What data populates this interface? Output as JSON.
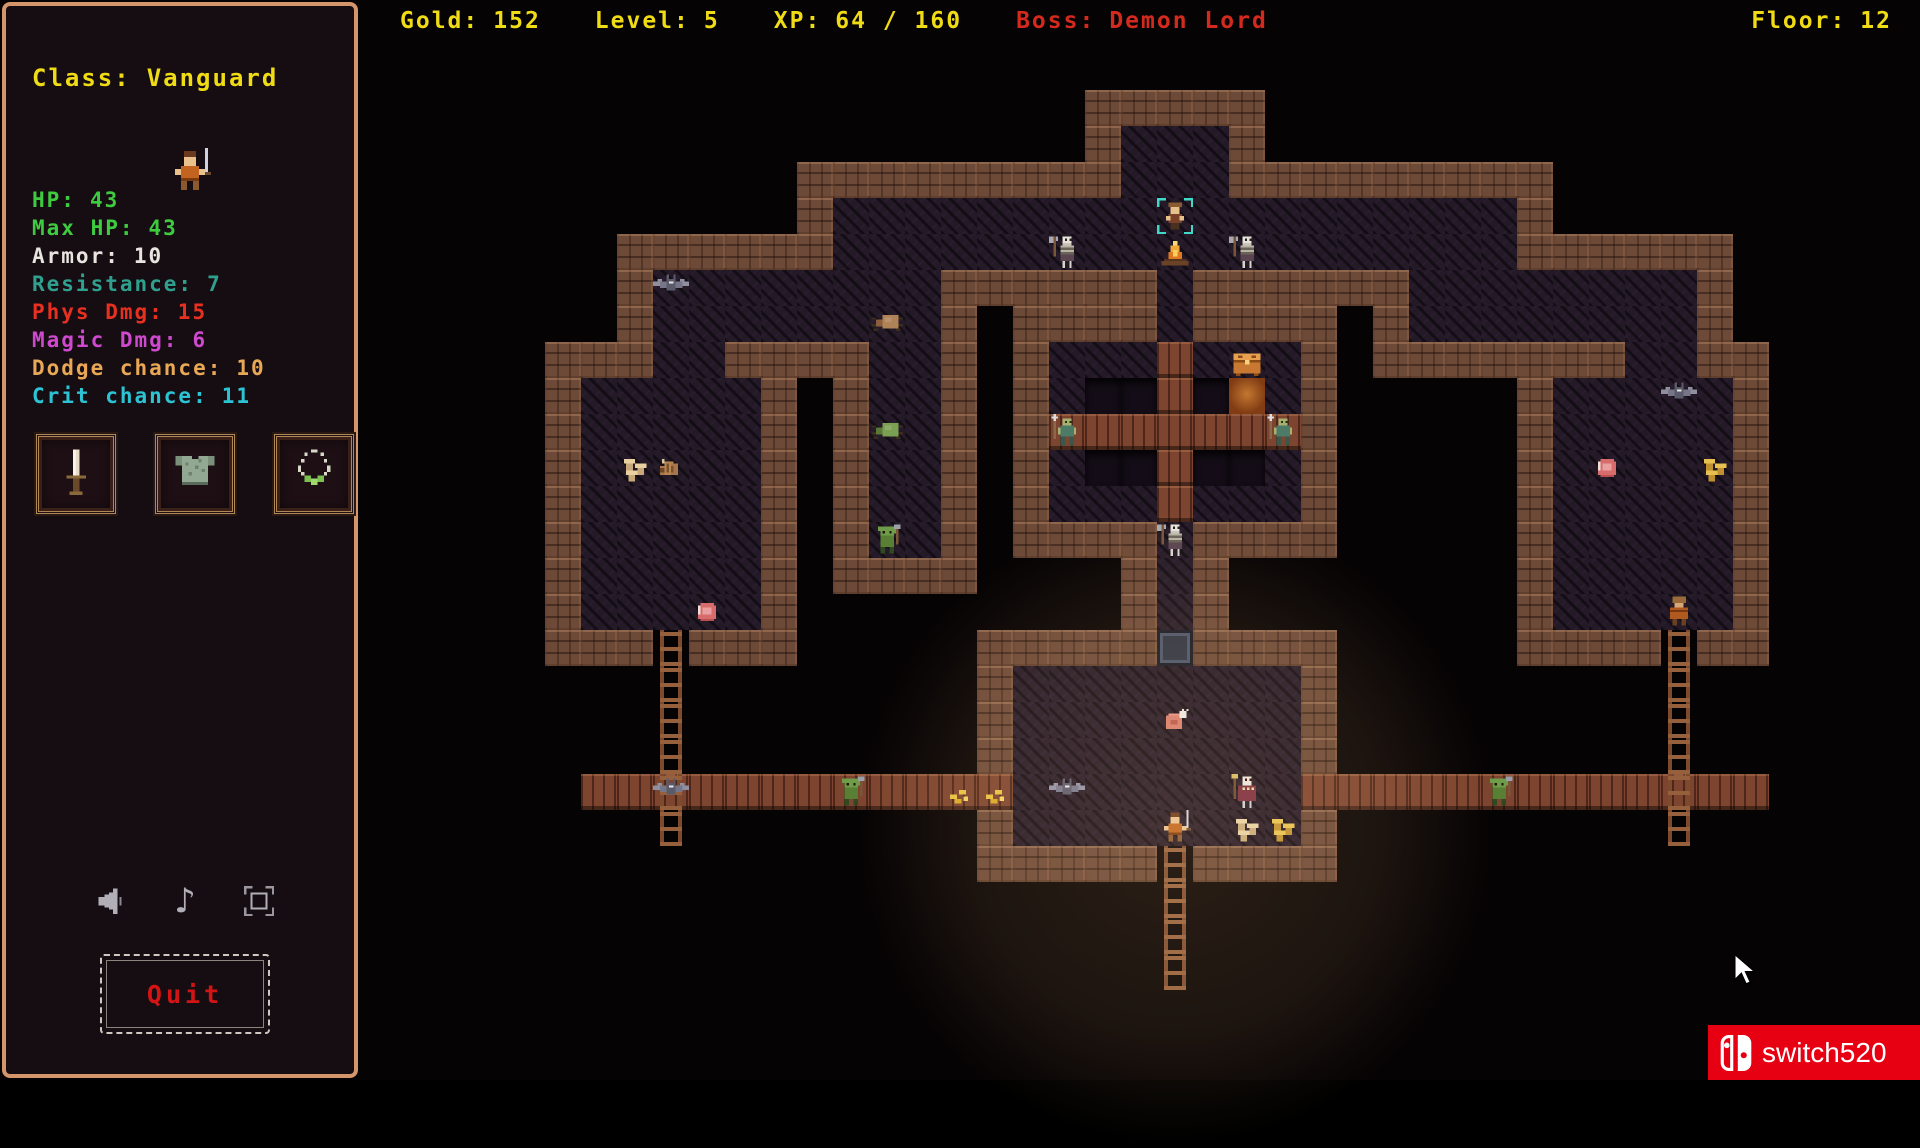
{
  "topbar": {
    "gold_label": "Gold:",
    "gold_value": "152",
    "level_label": "Level:",
    "level_value": "5",
    "xp_label": "XP:",
    "xp_value": "64 / 160",
    "boss_label": "Boss:",
    "boss_value": "Demon Lord",
    "floor_label": "Floor:",
    "floor_value": "12",
    "text_color": "#f0dc14",
    "boss_color": "#d42a1e"
  },
  "sidebar": {
    "class_label": "Class:",
    "class_value": "Vanguard",
    "stats": [
      {
        "label": "HP:",
        "value": "43",
        "color": "#3ecb40"
      },
      {
        "label": "Max HP:",
        "value": "43",
        "color": "#3ecb40"
      },
      {
        "label": "Armor:",
        "value": "10",
        "color": "#e8e4e0"
      },
      {
        "label": "Resistance:",
        "value": "7",
        "color": "#2fa08e"
      },
      {
        "label": "Phys Dmg:",
        "value": "15",
        "color": "#e83020"
      },
      {
        "label": "Magic Dmg:",
        "value": "6",
        "color": "#cf49cf"
      },
      {
        "label": "Dodge chance:",
        "value": "10",
        "color": "#e8a855"
      },
      {
        "label": "Crit chance:",
        "value": "11",
        "color": "#2cc4d4"
      }
    ],
    "equipment": [
      {
        "slot": "weapon-slot",
        "icon": "dagger"
      },
      {
        "slot": "armor-slot",
        "icon": "chestplate"
      },
      {
        "slot": "amulet-slot",
        "icon": "necklace"
      }
    ],
    "audio": [
      {
        "name": "volume-icon"
      },
      {
        "name": "music-icon"
      },
      {
        "name": "fullscreen-icon"
      }
    ],
    "quit_label": "Quit",
    "border_color": "#d4956a"
  },
  "watermark": {
    "text": "switch520",
    "bg": "#e60012"
  },
  "map": {
    "tile": 36,
    "origin_x": 545,
    "origin_y": 90,
    "cols": 35,
    "rows": 26,
    "floors": [
      {
        "x": 16,
        "y": 1,
        "w": 3,
        "h": 4
      },
      {
        "x": 8,
        "y": 3,
        "w": 8,
        "h": 2
      },
      {
        "x": 19,
        "y": 3,
        "w": 8,
        "h": 2
      },
      {
        "x": 3,
        "y": 5,
        "w": 6,
        "h": 2
      },
      {
        "x": 3,
        "y": 6,
        "w": 2,
        "h": 2
      },
      {
        "x": 9,
        "y": 5,
        "w": 2,
        "h": 8
      },
      {
        "x": 24,
        "y": 5,
        "w": 8,
        "h": 2
      },
      {
        "x": 30,
        "y": 6,
        "w": 2,
        "h": 2
      },
      {
        "x": 1,
        "y": 8,
        "w": 5,
        "h": 7
      },
      {
        "x": 28,
        "y": 8,
        "w": 5,
        "h": 7
      },
      {
        "x": 17,
        "y": 5,
        "w": 1,
        "h": 2
      },
      {
        "x": 14,
        "y": 7,
        "w": 7,
        "h": 5
      },
      {
        "x": 17,
        "y": 12,
        "w": 1,
        "h": 4
      },
      {
        "x": 13,
        "y": 16,
        "w": 8,
        "h": 5
      }
    ],
    "pits": [
      {
        "x": 15,
        "y": 8,
        "w": 2,
        "h": 1
      },
      {
        "x": 18,
        "y": 8,
        "w": 2,
        "h": 1
      },
      {
        "x": 15,
        "y": 10,
        "w": 2,
        "h": 1
      },
      {
        "x": 18,
        "y": 10,
        "w": 2,
        "h": 1
      }
    ],
    "embers": [
      {
        "x": 19,
        "y": 8
      }
    ],
    "bridges": [
      {
        "x": 1,
        "y": 19,
        "w": 12,
        "h": 1
      },
      {
        "x": 21,
        "y": 19,
        "w": 13,
        "h": 1
      },
      {
        "x": 17,
        "y": 7,
        "w": 1,
        "h": 5
      },
      {
        "x": 14,
        "y": 9,
        "w": 7,
        "h": 1
      }
    ],
    "ladders": [
      {
        "x": 3,
        "y": 15,
        "h": 6
      },
      {
        "x": 31,
        "y": 15,
        "h": 6
      },
      {
        "x": 17,
        "y": 21,
        "h": 4
      }
    ],
    "door": {
      "x": 17,
      "y": 15
    },
    "entities": [
      {
        "type": "dwarf-npc",
        "x": 17,
        "y": 3
      },
      {
        "type": "campfire",
        "x": 17,
        "y": 4
      },
      {
        "type": "skeleton-axe",
        "x": 14,
        "y": 4
      },
      {
        "type": "skeleton-axe",
        "x": 19,
        "y": 4
      },
      {
        "type": "bat",
        "x": 3,
        "y": 5
      },
      {
        "type": "spider-brown",
        "x": 9,
        "y": 6
      },
      {
        "type": "spider-green",
        "x": 9,
        "y": 9
      },
      {
        "type": "goblin",
        "x": 9,
        "y": 12
      },
      {
        "type": "mushrooms-white",
        "x": 2,
        "y": 10
      },
      {
        "type": "grub",
        "x": 3,
        "y": 10
      },
      {
        "type": "meat",
        "x": 4,
        "y": 14
      },
      {
        "type": "zombie",
        "x": 14,
        "y": 9
      },
      {
        "type": "zombie",
        "x": 20,
        "y": 9
      },
      {
        "type": "chest",
        "x": 19,
        "y": 7
      },
      {
        "type": "skeleton-axe",
        "x": 17,
        "y": 12
      },
      {
        "type": "ham",
        "x": 17,
        "y": 17
      },
      {
        "type": "player",
        "x": 17,
        "y": 20
      },
      {
        "type": "skeleton-priest",
        "x": 19,
        "y": 19
      },
      {
        "type": "mushrooms-white",
        "x": 19,
        "y": 20
      },
      {
        "type": "mushrooms-gold",
        "x": 20,
        "y": 20
      },
      {
        "type": "bat",
        "x": 14,
        "y": 19
      },
      {
        "type": "goblin",
        "x": 8,
        "y": 19
      },
      {
        "type": "bat",
        "x": 3,
        "y": 19
      },
      {
        "type": "coins",
        "x": 11,
        "y": 19
      },
      {
        "type": "coins",
        "x": 12,
        "y": 19
      },
      {
        "type": "goblin",
        "x": 26,
        "y": 19
      },
      {
        "type": "bat",
        "x": 31,
        "y": 8
      },
      {
        "type": "meat",
        "x": 29,
        "y": 10
      },
      {
        "type": "mushrooms-gold",
        "x": 32,
        "y": 10
      },
      {
        "type": "warrior-armored",
        "x": 31,
        "y": 14
      }
    ],
    "glow": {
      "cx": 17.5,
      "cy": 20.5,
      "r": 320
    }
  },
  "cursor": {
    "x": 1732,
    "y": 952
  }
}
